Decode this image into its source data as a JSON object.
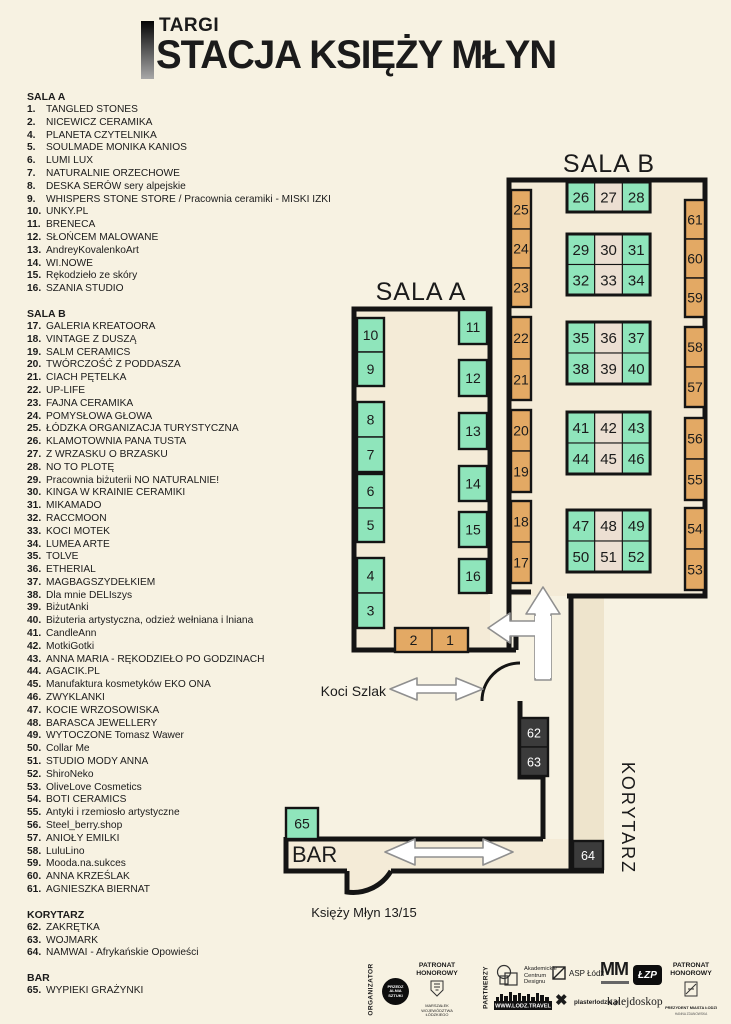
{
  "title": {
    "kicker": "TARGI",
    "main": "STACJA KSIĘŻY MŁYN"
  },
  "legend": {
    "sections": [
      {
        "header": "SALA A",
        "items": [
          [
            "1.",
            "TANGLED STONES"
          ],
          [
            "2.",
            "NICEWICZ CERAMIKA"
          ],
          [
            "4.",
            "PLANETA CZYTELNIKA"
          ],
          [
            "5.",
            "SOULMADE MONIKA KANIOS"
          ],
          [
            "6.",
            "LUMI LUX"
          ],
          [
            "7.",
            "NATURALNIE ORZECHOWE"
          ],
          [
            "8.",
            "DESKA SERÓW sery alpejskie"
          ],
          [
            "9.",
            "WHISPERS STONE STORE / Pracownia ceramiki - MISKI IZKI"
          ],
          [
            "10.",
            "UNKY.PL"
          ],
          [
            "11.",
            "BRENECA"
          ],
          [
            "12.",
            "SŁOŃCEM MALOWANE"
          ],
          [
            "13.",
            "AndreyKovalenkoArt"
          ],
          [
            "14.",
            "WI.NOWE"
          ],
          [
            "15.",
            "Rękodzieło ze skóry"
          ],
          [
            "16.",
            "SZANIA STUDIO"
          ]
        ]
      },
      {
        "header": "SALA B",
        "items": [
          [
            "17.",
            "GALERIA KREATOORA"
          ],
          [
            "18.",
            "VINTAGE Z DUSZĄ"
          ],
          [
            "19.",
            "SALM CERAMICS"
          ],
          [
            "20.",
            "TWÓRCZOŚĆ Z PODDASZA"
          ],
          [
            "21.",
            "CIACH PĘTELKA"
          ],
          [
            "22.",
            "UP-LIFE"
          ],
          [
            "23.",
            "FAJNA CERAMIKA"
          ],
          [
            "24.",
            "POMYSŁOWA GŁOWA"
          ],
          [
            "25.",
            "ŁÓDZKA ORGANIZACJA TURYSTYCZNA"
          ],
          [
            "26.",
            "KLAMOTOWNIA PANA TUSTA"
          ],
          [
            "27.",
            "Z WRZASKU O BRZASKU"
          ],
          [
            "28.",
            "NO TO PLOTĘ"
          ],
          [
            "29.",
            "Pracownia biżuterii NO NATURALNIE!"
          ],
          [
            "30.",
            "KINGA W KRAINIE CERAMIKI"
          ],
          [
            "31.",
            "MIKAMADO"
          ],
          [
            "32.",
            "RACCMOON"
          ],
          [
            "33.",
            "KOCI MOTEK"
          ],
          [
            "34.",
            "LUMEA ARTE"
          ],
          [
            "35.",
            "TOLVE"
          ],
          [
            "36.",
            "ETHERIAL"
          ],
          [
            "37.",
            "MAGBAGSZYDEŁKIEM"
          ],
          [
            "38.",
            "Dla mnie DELIszys"
          ],
          [
            "39.",
            "BiżutAnki"
          ],
          [
            "40.",
            "Biżuteria artystyczna, odzież wełniana i lniana"
          ],
          [
            "41.",
            "CandleAnn"
          ],
          [
            "42.",
            "MotkiGotki"
          ],
          [
            "43.",
            "ANNA MARIA - RĘKODZIEŁO PO GODZINACH"
          ],
          [
            "44.",
            "AGACIK.PL"
          ],
          [
            "45.",
            "Manufaktura kosmetyków EKO ONA"
          ],
          [
            "46.",
            "ZWYKLANKI"
          ],
          [
            "47.",
            "KOCIE WRZOSOWISKA"
          ],
          [
            "48.",
            "BARASCA JEWELLERY"
          ],
          [
            "49.",
            "WYTOCZONE Tomasz Wawer"
          ],
          [
            "50.",
            "Collar Me"
          ],
          [
            "51.",
            "STUDIO MODY ANNA"
          ],
          [
            "52.",
            "ShiroNeko"
          ],
          [
            "53.",
            "OliveLove Cosmetics"
          ],
          [
            "54.",
            "BOTI CERAMICS"
          ],
          [
            "55.",
            "Antyki i rzemiosło artystyczne"
          ],
          [
            "56.",
            "Steel_berry.shop"
          ],
          [
            "57.",
            "ANIOŁY EMILKI"
          ],
          [
            "58.",
            "LuluLino"
          ],
          [
            "59.",
            "Mooda.na.sukces"
          ],
          [
            "60.",
            "ANNA KRZEŚLAK"
          ],
          [
            "61.",
            "AGNIESZKA BIERNAT"
          ]
        ]
      },
      {
        "header": "KORYTARZ",
        "items": [
          [
            "62.",
            "ZAKRĘTKA"
          ],
          [
            "63.",
            "WOJMARK"
          ],
          [
            "64.",
            "NAMWAI - Afrykańskie Opowieści"
          ]
        ]
      },
      {
        "header": "BAR",
        "items": [
          [
            "65.",
            "WYPIEKI GRAŻYNKI"
          ]
        ]
      }
    ]
  },
  "map": {
    "labels": {
      "sala_a": "SALA A",
      "sala_b": "SALA B",
      "bar": "BAR",
      "korytarz": "KORYTARZ",
      "koci_szlak": "Koci Szlak",
      "entrance": "Księży Młyn 13/15"
    },
    "colors": {
      "green": "#8fe5bb",
      "tan": "#e3a964",
      "beige": "#ecdfd2",
      "dark": "#3b3b3b",
      "wall": "#141414",
      "room": "#f4ebd7",
      "strip": "#eee4cc"
    },
    "boxes": [
      {
        "n": "25",
        "x": 511,
        "y": 190,
        "w": 20,
        "h": 39,
        "c": "t"
      },
      {
        "n": "24",
        "x": 511,
        "y": 229,
        "w": 20,
        "h": 39,
        "c": "t"
      },
      {
        "n": "23",
        "x": 511,
        "y": 268,
        "w": 20,
        "h": 39,
        "c": "t"
      },
      {
        "n": "22",
        "x": 511,
        "y": 317,
        "w": 20,
        "h": 42,
        "c": "t"
      },
      {
        "n": "21",
        "x": 511,
        "y": 359,
        "w": 20,
        "h": 41,
        "c": "t"
      },
      {
        "n": "20",
        "x": 511,
        "y": 410,
        "w": 20,
        "h": 41,
        "c": "t"
      },
      {
        "n": "19",
        "x": 511,
        "y": 451,
        "w": 20,
        "h": 41,
        "c": "t"
      },
      {
        "n": "18",
        "x": 511,
        "y": 501,
        "w": 20,
        "h": 41,
        "c": "t"
      },
      {
        "n": "17",
        "x": 511,
        "y": 542,
        "w": 20,
        "h": 41,
        "c": "t"
      },
      {
        "n": "61",
        "x": 685,
        "y": 200,
        "w": 20,
        "h": 39,
        "c": "t"
      },
      {
        "n": "60",
        "x": 685,
        "y": 239,
        "w": 20,
        "h": 39,
        "c": "t"
      },
      {
        "n": "59",
        "x": 685,
        "y": 278,
        "w": 20,
        "h": 39,
        "c": "t"
      },
      {
        "n": "58",
        "x": 685,
        "y": 327,
        "w": 20,
        "h": 40,
        "c": "t"
      },
      {
        "n": "57",
        "x": 685,
        "y": 367,
        "w": 20,
        "h": 40,
        "c": "t"
      },
      {
        "n": "56",
        "x": 685,
        "y": 418,
        "w": 20,
        "h": 41,
        "c": "t"
      },
      {
        "n": "55",
        "x": 685,
        "y": 459,
        "w": 20,
        "h": 41,
        "c": "t"
      },
      {
        "n": "54",
        "x": 685,
        "y": 508,
        "w": 20,
        "h": 41,
        "c": "t"
      },
      {
        "n": "53",
        "x": 685,
        "y": 549,
        "w": 20,
        "h": 41,
        "c": "t"
      },
      {
        "n": "10",
        "x": 357,
        "y": 318,
        "w": 27,
        "h": 34,
        "c": "g"
      },
      {
        "n": "9",
        "x": 357,
        "y": 352,
        "w": 27,
        "h": 34,
        "c": "g"
      },
      {
        "n": "8",
        "x": 357,
        "y": 402,
        "w": 27,
        "h": 35,
        "c": "g"
      },
      {
        "n": "7",
        "x": 357,
        "y": 437,
        "w": 27,
        "h": 35,
        "c": "g"
      },
      {
        "n": "6",
        "x": 357,
        "y": 474,
        "w": 27,
        "h": 34,
        "c": "g"
      },
      {
        "n": "5",
        "x": 357,
        "y": 508,
        "w": 27,
        "h": 34,
        "c": "g"
      },
      {
        "n": "4",
        "x": 357,
        "y": 558,
        "w": 27,
        "h": 35,
        "c": "g"
      },
      {
        "n": "3",
        "x": 357,
        "y": 593,
        "w": 27,
        "h": 35,
        "c": "g"
      },
      {
        "n": "11",
        "x": 459,
        "y": 310,
        "w": 28,
        "h": 34,
        "c": "g"
      },
      {
        "n": "12",
        "x": 459,
        "y": 360,
        "w": 28,
        "h": 36,
        "c": "g"
      },
      {
        "n": "13",
        "x": 459,
        "y": 413,
        "w": 28,
        "h": 36,
        "c": "g"
      },
      {
        "n": "14",
        "x": 459,
        "y": 466,
        "w": 28,
        "h": 35,
        "c": "g"
      },
      {
        "n": "15",
        "x": 459,
        "y": 512,
        "w": 28,
        "h": 35,
        "c": "g"
      },
      {
        "n": "16",
        "x": 459,
        "y": 559,
        "w": 28,
        "h": 34,
        "c": "g"
      },
      {
        "n": "2",
        "x": 395,
        "y": 628,
        "w": 37,
        "h": 24,
        "c": "t"
      },
      {
        "n": "1",
        "x": 432,
        "y": 628,
        "w": 36,
        "h": 24,
        "c": "t"
      },
      {
        "n": "62",
        "x": 520,
        "y": 718,
        "w": 28,
        "h": 29,
        "c": "d"
      },
      {
        "n": "63",
        "x": 520,
        "y": 747,
        "w": 28,
        "h": 29,
        "c": "d"
      },
      {
        "n": "64",
        "x": 573,
        "y": 841,
        "w": 30,
        "h": 28,
        "c": "d"
      },
      {
        "n": "65",
        "x": 286,
        "y": 808,
        "w": 32,
        "h": 31,
        "c": "g"
      }
    ],
    "groups": [
      [
        511,
        190,
        20,
        117
      ],
      [
        511,
        317,
        20,
        83
      ],
      [
        511,
        410,
        20,
        82
      ],
      [
        511,
        501,
        20,
        82
      ],
      [
        685,
        200,
        20,
        117
      ],
      [
        685,
        327,
        20,
        80
      ],
      [
        685,
        418,
        20,
        82
      ],
      [
        685,
        508,
        20,
        82
      ],
      [
        357,
        318,
        27,
        68
      ],
      [
        357,
        402,
        27,
        70
      ],
      [
        357,
        474,
        27,
        68
      ],
      [
        357,
        558,
        27,
        70
      ],
      [
        459,
        310,
        28,
        34
      ],
      [
        459,
        360,
        28,
        36
      ],
      [
        459,
        413,
        28,
        36
      ],
      [
        459,
        466,
        28,
        35
      ],
      [
        459,
        512,
        28,
        35
      ],
      [
        459,
        559,
        28,
        34
      ],
      [
        395,
        628,
        73,
        24
      ],
      [
        520,
        718,
        28,
        58
      ],
      [
        573,
        841,
        30,
        28
      ],
      [
        286,
        808,
        32,
        31
      ]
    ],
    "islands": [
      {
        "x": 567,
        "y": 182,
        "cw": 27.7,
        "rh": 30,
        "rows": [
          [
            [
              "26",
              "g"
            ],
            [
              "27",
              "b"
            ],
            [
              "28",
              "g"
            ]
          ]
        ]
      },
      {
        "x": 567,
        "y": 234,
        "cw": 27.7,
        "rh": 30.5,
        "rows": [
          [
            [
              "29",
              "g"
            ],
            [
              "30",
              "b"
            ],
            [
              "31",
              "g"
            ]
          ],
          [
            [
              "32",
              "g"
            ],
            [
              "33",
              "b"
            ],
            [
              "34",
              "g"
            ]
          ]
        ]
      },
      {
        "x": 567,
        "y": 322,
        "cw": 27.7,
        "rh": 31,
        "rows": [
          [
            [
              "35",
              "g"
            ],
            [
              "36",
              "b"
            ],
            [
              "37",
              "g"
            ]
          ],
          [
            [
              "38",
              "g"
            ],
            [
              "39",
              "b"
            ],
            [
              "40",
              "g"
            ]
          ]
        ]
      },
      {
        "x": 567,
        "y": 412,
        "cw": 27.7,
        "rh": 31,
        "rows": [
          [
            [
              "41",
              "g"
            ],
            [
              "42",
              "b"
            ],
            [
              "43",
              "g"
            ]
          ],
          [
            [
              "44",
              "g"
            ],
            [
              "45",
              "b"
            ],
            [
              "46",
              "g"
            ]
          ]
        ]
      },
      {
        "x": 567,
        "y": 510,
        "cw": 27.7,
        "rh": 31,
        "rows": [
          [
            [
              "47",
              "g"
            ],
            [
              "48",
              "b"
            ],
            [
              "49",
              "g"
            ]
          ],
          [
            [
              "50",
              "g"
            ],
            [
              "51",
              "b"
            ],
            [
              "52",
              "g"
            ]
          ]
        ]
      }
    ]
  },
  "footer": {
    "organizer_label": "ORGANIZATOR",
    "organizer_logo": [
      "PRZEDZ",
      "ALNIA",
      "SZTUKI"
    ],
    "patronat1_label": "PATRONAT HONOROWY",
    "patronat1_sub": "MARSZAŁEK WOJEWÓDZTWA ŁÓDZKIEGO",
    "partners_label": "PARTNERZY",
    "acd": [
      "Akademickie",
      "Centrum",
      "Designu"
    ],
    "asp": "ASP Łódź",
    "lodz_travel": "WWW.LODZ.TRAVEL",
    "plaster": "plasterlodzki.pl",
    "mm": "MM",
    "kalejdoskop": "kalejdoskop",
    "lzp": "ŁZP",
    "patronat2_label": "PATRONAT HONOROWY",
    "patronat2_sub": "PREZYDENT MIASTA ŁODZI",
    "patronat2_name": "HANNA ZDANOWSKA"
  }
}
